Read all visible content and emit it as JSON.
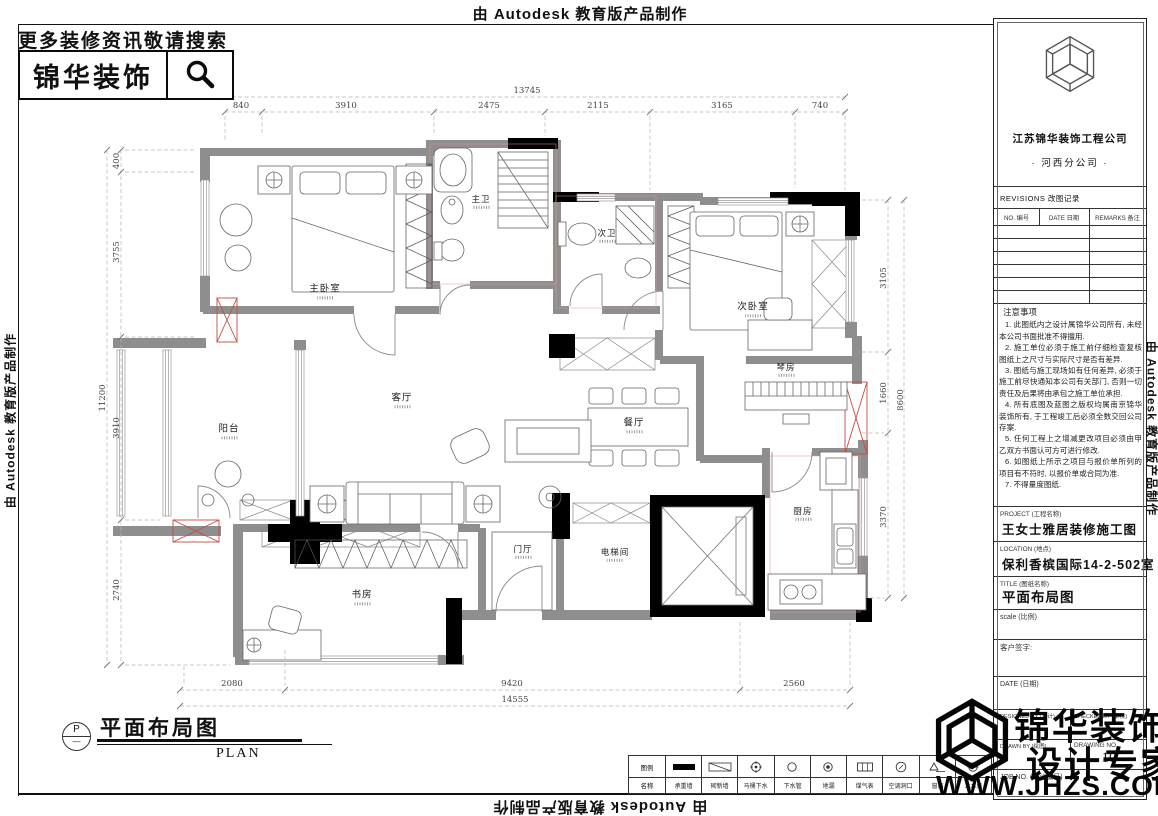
{
  "banner": {
    "text": "由 Autodesk 教育版产品制作"
  },
  "header": {
    "tagline": "更多装修资讯敬请搜索",
    "brand": "锦华装饰"
  },
  "plan": {
    "rooms": [
      {
        "name": "主卧室"
      },
      {
        "name": "主卫"
      },
      {
        "name": "次卫"
      },
      {
        "name": "次卧室"
      },
      {
        "name": "琴房"
      },
      {
        "name": "餐厅"
      },
      {
        "name": "客厅"
      },
      {
        "name": "阳台"
      },
      {
        "name": "书房"
      },
      {
        "name": "门厅"
      },
      {
        "name": "电梯间"
      },
      {
        "name": "厨房"
      }
    ],
    "dims": {
      "top": {
        "total": "13745",
        "segments": [
          "840",
          "3910",
          "2475",
          "2115",
          "3165",
          "740"
        ]
      },
      "left": {
        "total": "11200",
        "segments": [
          "400",
          "3755",
          "3910",
          "2740"
        ]
      },
      "right": {
        "total": "8600",
        "segments": [
          "3105",
          "1660",
          "3370"
        ]
      },
      "bottom": {
        "total": "14555",
        "segments": [
          "2080",
          "9420",
          "2560"
        ]
      }
    }
  },
  "plan_title": {
    "bubble": "P",
    "title": "平面布局图",
    "subtitle": "PLAN"
  },
  "legend": {
    "header": {
      "top": "图例",
      "bottom": "名称"
    },
    "items": [
      {
        "icon": "bearing-wall",
        "label": "承重墙"
      },
      {
        "icon": "new-wall",
        "label": "砌新墙"
      },
      {
        "icon": "toilet-drain",
        "label": "马桶下水"
      },
      {
        "icon": "drain-pipe",
        "label": "下水管"
      },
      {
        "icon": "floor-drain",
        "label": "地漏"
      },
      {
        "icon": "gas-meter",
        "label": "煤气表"
      },
      {
        "icon": "ac-opening",
        "label": "空调洞口"
      },
      {
        "icon": "window-height",
        "label": "窗高"
      },
      {
        "icon": "water-supply",
        "label": "上水位"
      }
    ]
  },
  "title_block": {
    "company": "江苏锦华装饰工程公司",
    "branch": "· 河西分公司 ·",
    "revisions_title": "REVISIONS 改图记录",
    "rev_cols": [
      "NO. 编号",
      "DATE 日期",
      "REMARKS 备注"
    ],
    "notes_title": "注意事项",
    "notes": [
      "1. 此图纸内之设计属锦华公司所有, 未经本公司书面批准不得擅用.",
      "2. 施工单位必须于施工前仔细检查复核图纸上之尺寸与实际尺寸是否有差异.",
      "3. 图纸与施工现场如有任何差异, 必须于施工前尽快通知本公司有关部门, 否则一切责任及后果将由承包之施工单位承担.",
      "4. 所有底图及蓝图之版权均属南京锦华装饰所有, 于工程竣工后必须全数交回公司存案.",
      "5. 任何工程上之增减更改项目必须由甲乙双方书面认可方可进行修改.",
      "6. 如图纸上所示之项目与报价单所列的项目有不符时, 以报价单或合同为准.",
      "7. 不得量度图纸."
    ],
    "project_label": "PROJECT (工程名称)",
    "project_value": "王女士雅居装修施工图",
    "location_label": "LOCATION (地点)",
    "location_value": "保利香槟国际14-2-502室",
    "title_label": "TITLE (图纸名称)",
    "title_value": "平面布局图",
    "scale_label": "scale  (比例)",
    "client_label": "客户签字:",
    "date_label": "DATE (日期)",
    "designed_label": "DESIGNED BY (设计)",
    "checked_label": "CHECKED BY (审核)",
    "drawn_label": "DRAWN BY (绘图)",
    "drawing_no_label": "DRAWING NO.",
    "drawing_no_value": "10",
    "job_label": "JOB NO. (设计编号)"
  },
  "watermark": {
    "line1": "锦华装饰",
    "line2": "设计专家",
    "line3": "WWW.JHZS.COM"
  }
}
